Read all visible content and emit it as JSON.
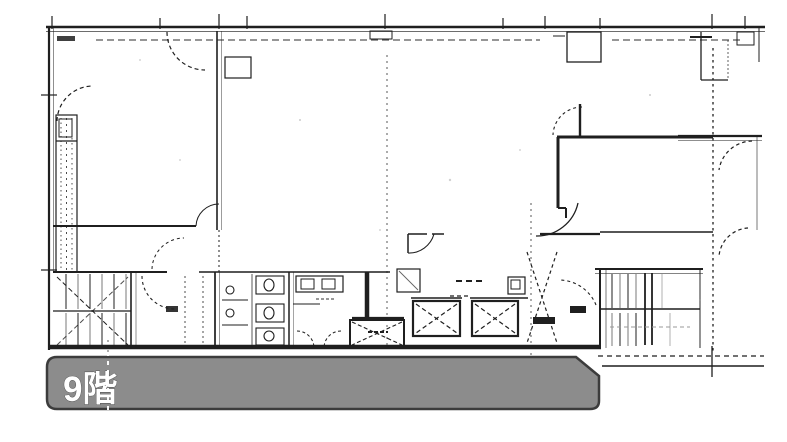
{
  "floor_banner": {
    "label": "9階"
  },
  "colors": {
    "bg": "#ffffff",
    "ink": "#1f1f1f",
    "faint": "#8a8a8a",
    "banner_fill": "#8c8c8c",
    "banner_border": "#3c3c3c",
    "banner_text": "#ffffff"
  }
}
